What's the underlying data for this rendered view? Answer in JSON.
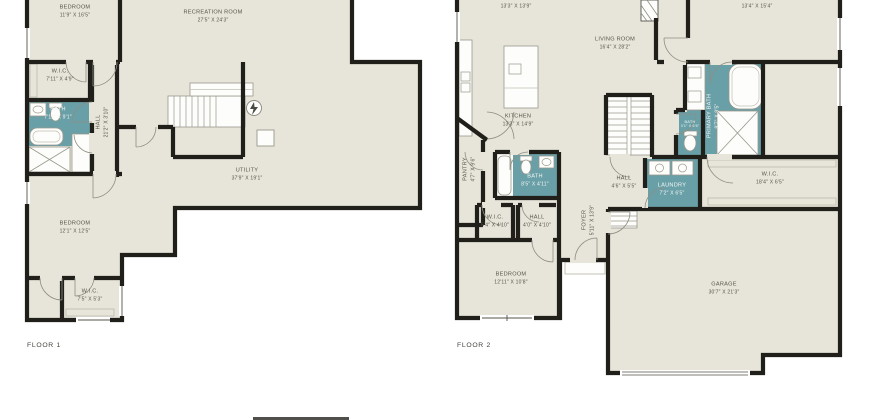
{
  "title": "Two-storey house floor plan",
  "colors": {
    "background": "#ffffff",
    "floor_fill": "#e7e5da",
    "wall": "#211f1a",
    "bath_fill": "#69a0a8",
    "label_text": "#57554c",
    "bath_label_text": "#f4f6f4"
  },
  "floor1": {
    "label": "FLOOR 1",
    "rooms": [
      {
        "id": "bedroom-upper",
        "name": "BEDROOM",
        "dims": "11'9\" X 16'5\""
      },
      {
        "id": "recreation",
        "name": "RECREATION ROOM",
        "dims": "27'5\" X 24'3\""
      },
      {
        "id": "wic-upper",
        "name": "W.I.C.",
        "dims": "7'11\" X 4'9\""
      },
      {
        "id": "bath",
        "name": "BATH",
        "dims": "7'11\" X 9'1\""
      },
      {
        "id": "hall",
        "name": "HALL",
        "dims": "21'2\" X 3'10\""
      },
      {
        "id": "utility",
        "name": "UTILITY",
        "dims": "37'9\" X 19'1\""
      },
      {
        "id": "bedroom-lower",
        "name": "BEDROOM",
        "dims": "12'1\" X 12'5\""
      },
      {
        "id": "wic-lower",
        "name": "W.I.C.",
        "dims": "7'5\" X 5'3\""
      }
    ]
  },
  "floor2": {
    "label": "FLOOR 2",
    "rooms": [
      {
        "id": "dining",
        "name": "",
        "dims": "13'3\" X 13'9\""
      },
      {
        "id": "living-room",
        "name": "LIVING ROOM",
        "dims": "16'4\" X 28'2\""
      },
      {
        "id": "kitchen",
        "name": "KITCHEN",
        "dims": "13'3\" X 14'9\""
      },
      {
        "id": "pantry",
        "name": "PANTRY",
        "dims": "4'7\" X 9'6\""
      },
      {
        "id": "bath-main",
        "name": "BATH",
        "dims": "8'5\" X 4'11\""
      },
      {
        "id": "wic-small",
        "name": "W.I.C.",
        "dims": "5'4\" X 4'10\""
      },
      {
        "id": "hall-small",
        "name": "HALL",
        "dims": "4'0\" X 4'10\""
      },
      {
        "id": "foyer",
        "name": "FOYER",
        "dims": "5'11\" X 13'9\""
      },
      {
        "id": "hall-laundry",
        "name": "HALL",
        "dims": "4'6\" X 5'5\""
      },
      {
        "id": "laundry",
        "name": "LAUNDRY",
        "dims": "7'2\" X 6'5\""
      },
      {
        "id": "primary-bath",
        "name": "PRIMARY BATH",
        "dims": "9'7\" X 9'5\""
      },
      {
        "id": "toilet-bath",
        "name": "BATH",
        "dims": "3'1\" X 6'6\""
      },
      {
        "id": "primary-bedroom",
        "name": "",
        "dims": "13'4\" X 15'4\""
      },
      {
        "id": "wic-large",
        "name": "W.I.C.",
        "dims": "18'4\" X 6'5\""
      },
      {
        "id": "bedroom",
        "name": "BEDROOM",
        "dims": "12'11\" X 10'8\""
      },
      {
        "id": "garage",
        "name": "GARAGE",
        "dims": "30'7\" X 21'3\""
      }
    ]
  }
}
